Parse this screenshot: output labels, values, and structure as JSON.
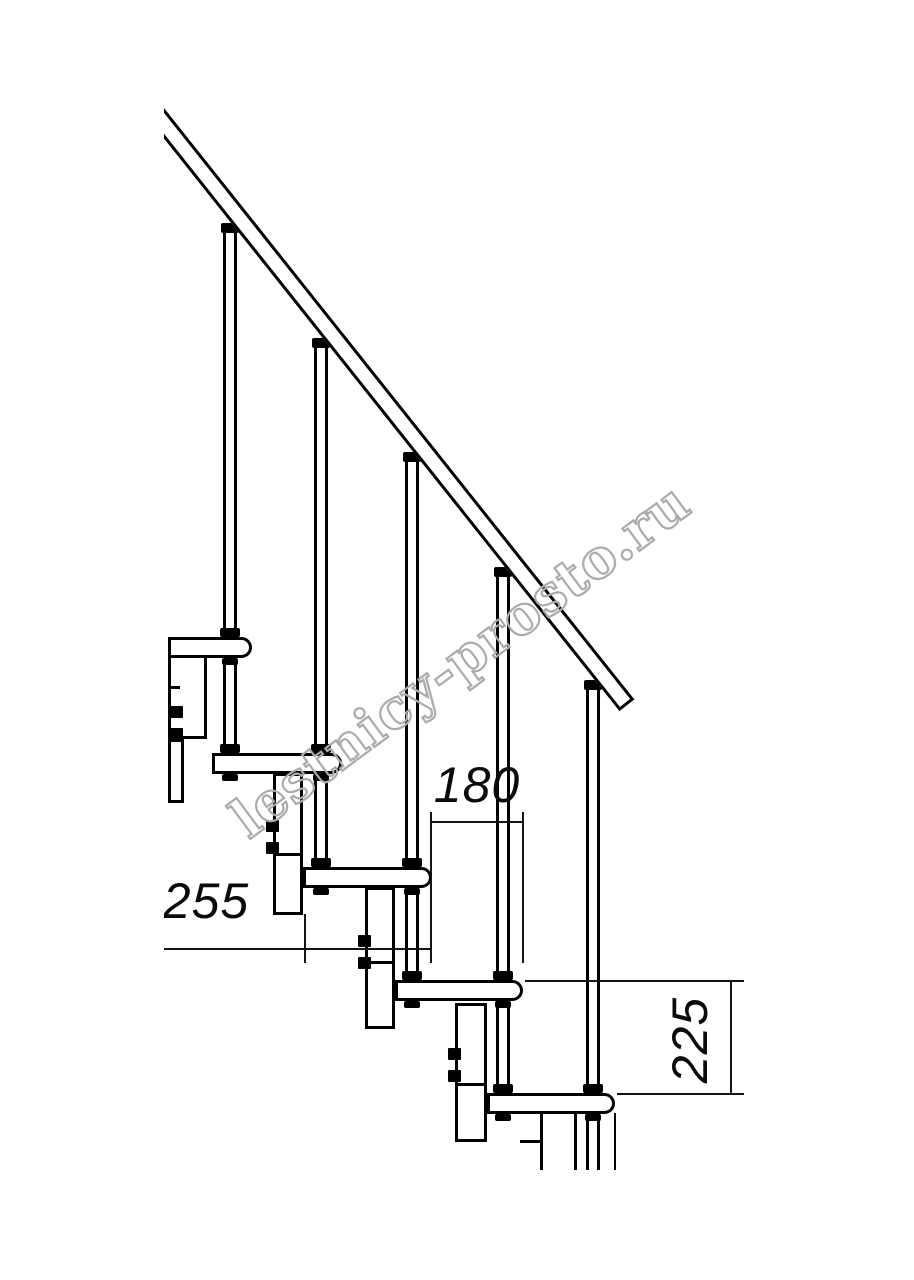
{
  "watermark": {
    "text": "lestnicy-prosto.ru",
    "color": "#ababab"
  },
  "dimensions": {
    "going": {
      "value": "180",
      "orientation": "horizontal"
    },
    "tread_depth": {
      "value": "255",
      "orientation": "horizontal"
    },
    "rise": {
      "value": "225",
      "orientation": "vertical"
    }
  },
  "drawing": {
    "subject": "modular staircase side elevation",
    "steps_visible": 5,
    "balusters_visible": 5,
    "handrail": true,
    "line_color": "#000000",
    "background_color": "#ffffff"
  }
}
